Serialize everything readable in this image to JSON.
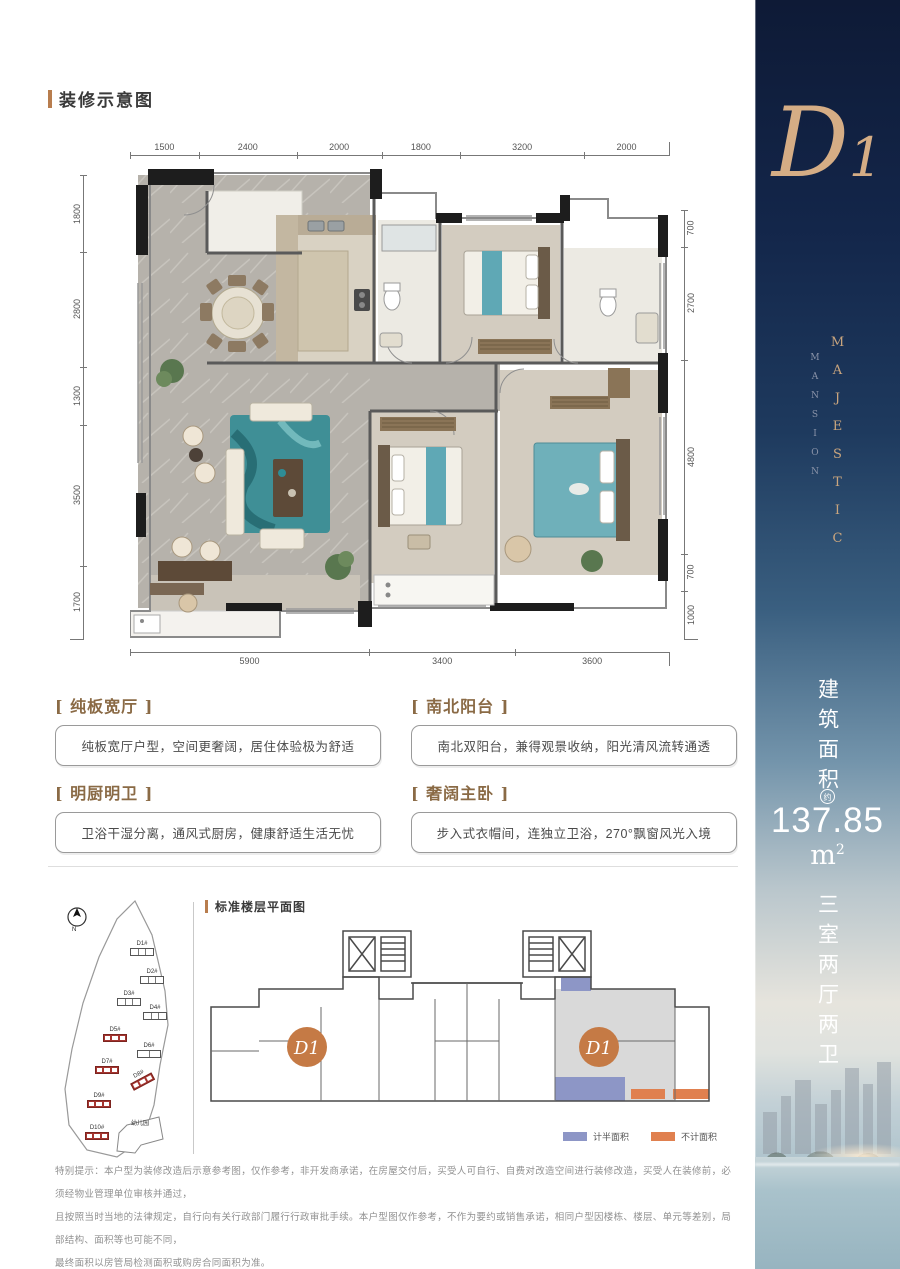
{
  "header": {
    "title": "装修示意图"
  },
  "floorplan": {
    "dims_top": [
      "1500",
      "2400",
      "2000",
      "1800",
      "3200",
      "2000"
    ],
    "dims_left": [
      "1800",
      "2800",
      "1300",
      "3500",
      "1700"
    ],
    "dims_right": [
      "700",
      "2700",
      "4800",
      "700",
      "1000"
    ],
    "dims_bottom": [
      "5900",
      "3400",
      "3600"
    ]
  },
  "features": [
    {
      "title": "[ 纯板宽厅 ]",
      "desc": "纯板宽厅户型，空间更奢阔，居住体验极为舒适"
    },
    {
      "title": "[ 南北阳台 ]",
      "desc": "南北双阳台，兼得观景收纳，阳光清风流转通透"
    },
    {
      "title": "[ 明厨明卫 ]",
      "desc": "卫浴干湿分离，通风式厨房，健康舒适生活无忧"
    },
    {
      "title": "[ 奢阔主卧 ]",
      "desc": "步入式衣帽间，连独立卫浴，270°飘窗风光入境"
    }
  ],
  "sidebar": {
    "unit_letter": "D",
    "unit_number": "1",
    "brand_line1": "MAJESTIC",
    "brand_line2": "MANSION",
    "area_label": "建筑面积",
    "area_approx": "约",
    "area_value": "137.85",
    "area_unit_base": "m",
    "area_unit_sup": "2",
    "layout": "三室两厅两卫",
    "colors": {
      "navy": "#0e1a36",
      "gold": "#d5ad85"
    }
  },
  "siteplan": {
    "north_label": "N",
    "buildings": [
      {
        "label": "D1#"
      },
      {
        "label": "D2#"
      },
      {
        "label": "D3#"
      },
      {
        "label": "D4#"
      },
      {
        "label": "D5#"
      },
      {
        "label": "D6#"
      },
      {
        "label": "D7#"
      },
      {
        "label": "D8#"
      },
      {
        "label": "D9#"
      },
      {
        "label": "D10#"
      }
    ],
    "kindergarten_label": "幼儿园",
    "highlight_color": "#a63530"
  },
  "standard_floor": {
    "title": "标准楼层平面图",
    "unit_label_left": "D1",
    "unit_label_right": "D1",
    "legend": [
      {
        "label": "计半面积",
        "color": "#8d96c6"
      },
      {
        "label": "不计面积",
        "color": "#e0804f"
      }
    ]
  },
  "disclaimer": {
    "lines": [
      "特别提示：本户型为装修改造后示意参考图，仅作参考，非开发商承诺，在房屋交付后，买受人可自行、自费对改造空间进行装修改造，买受人在装修前，必须经物业管理单位审核并通过，",
      "且按照当时当地的法律规定，自行向有关行政部门履行行政审批手续。本户型图仅作参考，不作为要约或销售承诺，相同户型因楼栋、楼层、单元等差别，局部结构、面积等也可能不同，",
      "最终面积以房管局检测面积或购房合同面积为准。"
    ]
  }
}
